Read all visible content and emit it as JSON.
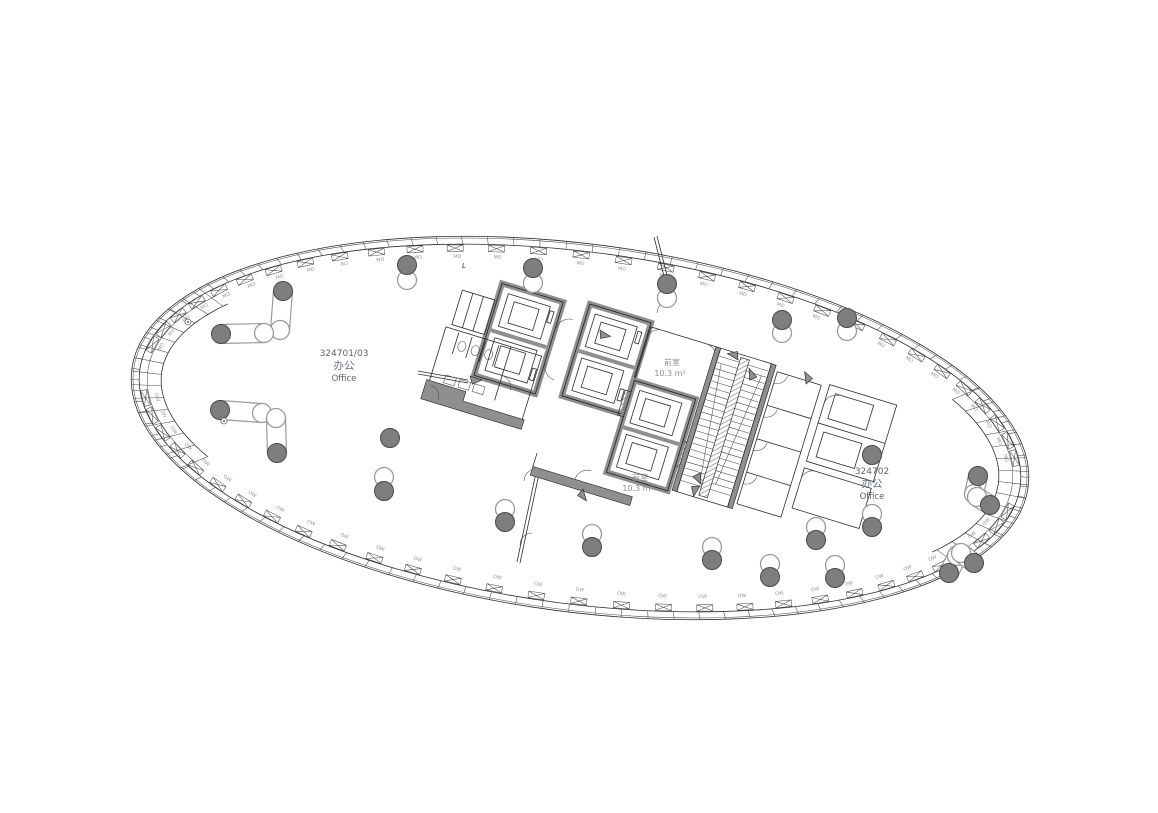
{
  "page": {
    "background": "#ffffff",
    "kind": "architectural floor plan"
  },
  "drawing": {
    "rooms": [
      {
        "number": "324701/03",
        "name_cn": "办公",
        "name_en": "Office"
      },
      {
        "number": "324702",
        "name_cn": "办公",
        "name_en": "Office"
      }
    ],
    "vestibules": [
      {
        "name_cn": "前室",
        "area": "10.3 m²"
      },
      {
        "name_cn": "前室",
        "area": "10.3 m²"
      }
    ],
    "facade": {
      "top_panel_labels": [
        "MO",
        "MO",
        "MO",
        "MO",
        "MO",
        "MO",
        "MO",
        "MO",
        "RO",
        "MO",
        "MO",
        "MO",
        "MO",
        "MO",
        "MO",
        "MO",
        "MO",
        "MO",
        "MO",
        "MO",
        "MO",
        "MO",
        "MO",
        "MO",
        "MO",
        "MO",
        "MO",
        "MO",
        "MO",
        "MO"
      ],
      "bottom_panel_labels": [
        "OW",
        "OW",
        "OW",
        "OW",
        "OW",
        "OW",
        "OW",
        "OW",
        "OW",
        "OW",
        "OW",
        "OW",
        "OW",
        "OW",
        "OW",
        "OW",
        "OW",
        "OW",
        "OW",
        "OW",
        "OW",
        "OW",
        "OW",
        "OW",
        "OW",
        "OW",
        "OW",
        "OW",
        "OW",
        "OW"
      ],
      "stray_mark": "L"
    },
    "colors": {
      "line": "#2e2e2e",
      "wall_gray": "#8f8f8f",
      "column_fill": "#7e7e7e",
      "column_stroke": "#4a4a4a",
      "open_column_stroke": "#9a9a9a",
      "mullion_label": "#8b94a8",
      "room_text": "#5c636f"
    },
    "columns": {
      "paired_top": [
        [
          407,
          265,
          280
        ],
        [
          533,
          268,
          283
        ],
        [
          667,
          284,
          298
        ],
        [
          782,
          320,
          333
        ],
        [
          847,
          318,
          331
        ]
      ],
      "paired_bottom": [
        [
          384,
          491,
          477
        ],
        [
          505,
          522,
          509
        ],
        [
          592,
          547,
          534
        ],
        [
          712,
          560,
          547
        ],
        [
          770,
          577,
          564
        ],
        [
          835,
          578,
          565
        ],
        [
          872,
          527,
          514
        ],
        [
          816,
          540,
          527
        ]
      ],
      "single_filled": [
        [
          390,
          438
        ],
        [
          872,
          455
        ]
      ],
      "survey_dots": [
        [
          188,
          322
        ],
        [
          224,
          421
        ]
      ],
      "inclined": [
        {
          "x1": 283,
          "y1": 291,
          "x2": 280,
          "y2": 330
        },
        {
          "x1": 221,
          "y1": 334,
          "x2": 264,
          "y2": 333
        },
        {
          "x1": 220,
          "y1": 410,
          "x2": 262,
          "y2": 413
        },
        {
          "x1": 277,
          "y1": 453,
          "x2": 276,
          "y2": 418
        },
        {
          "x1": 978,
          "y1": 476,
          "x2": 974,
          "y2": 494
        },
        {
          "x1": 990,
          "y1": 505,
          "x2": 977,
          "y2": 497
        },
        {
          "x1": 949,
          "y1": 573,
          "x2": 957,
          "y2": 556
        },
        {
          "x1": 974,
          "y1": 563,
          "x2": 961,
          "y2": 553
        }
      ]
    },
    "envelope": {
      "cx": 580,
      "cy": 428,
      "rx": 452,
      "ry": 184,
      "rotation_deg": 7.5,
      "inner_offset": 8,
      "tip_band_offset": 30,
      "tip_mid_offset": 16
    }
  }
}
